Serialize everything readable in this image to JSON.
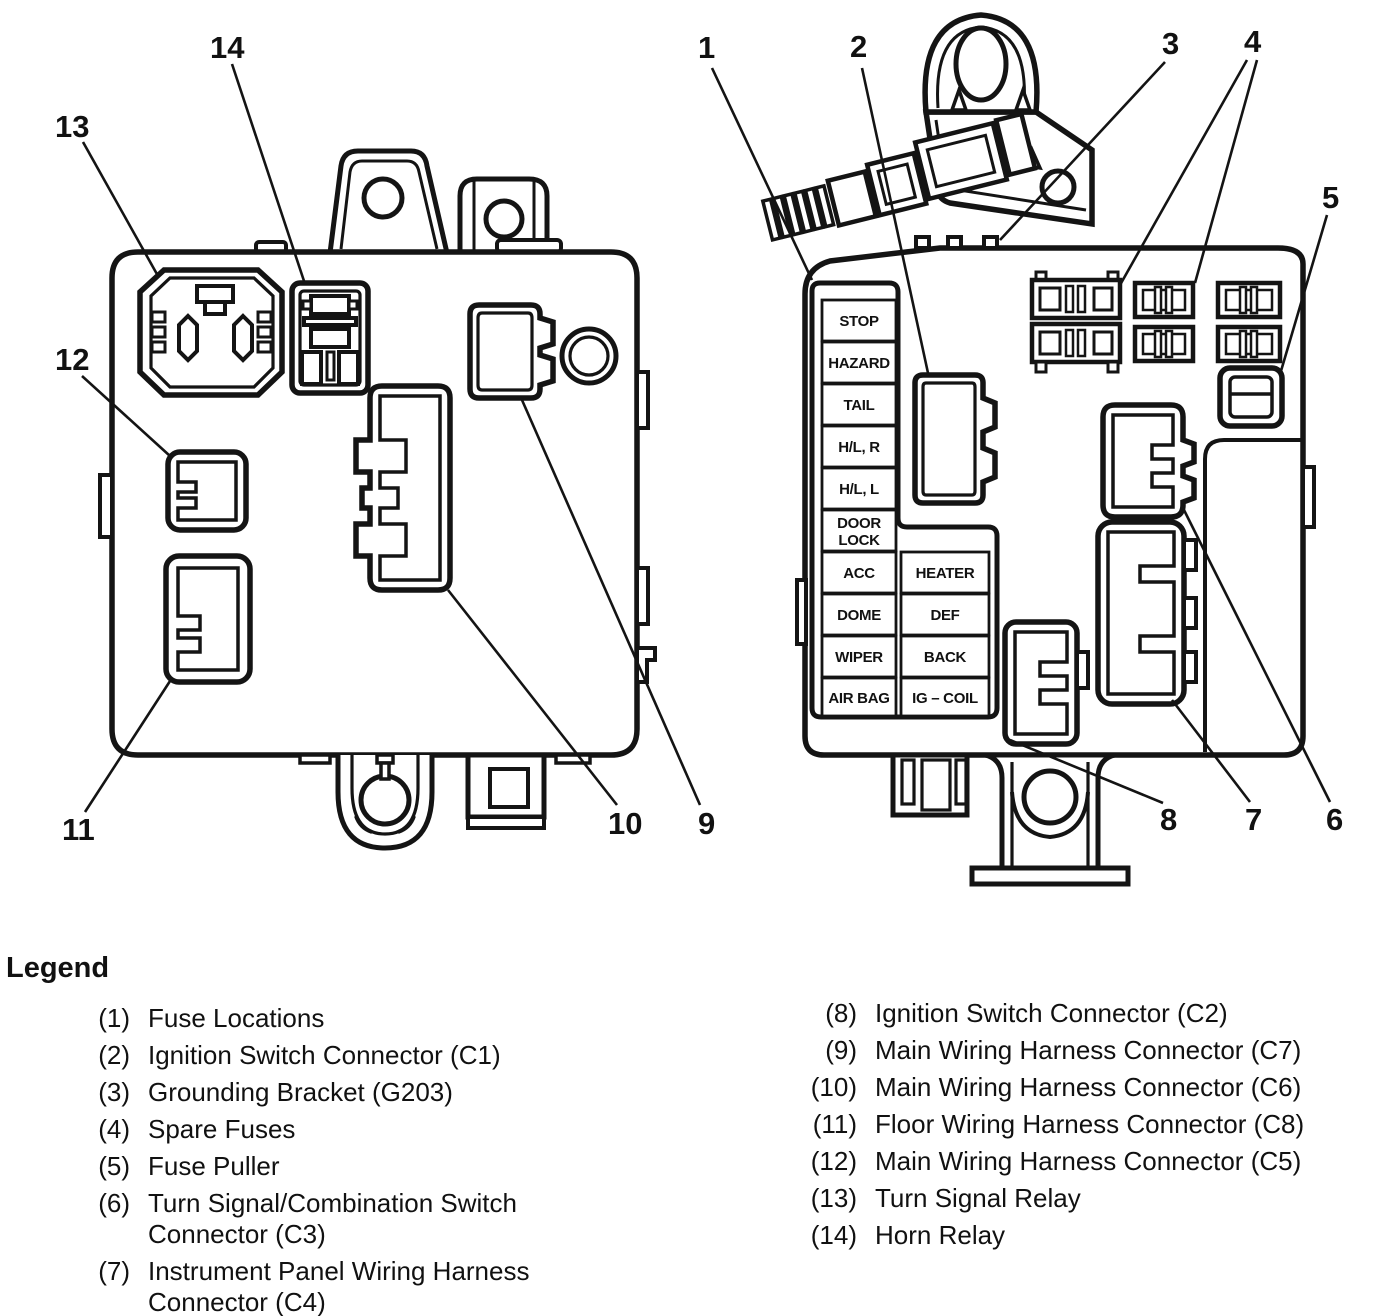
{
  "figure": {
    "type": "fuse-block-diagram",
    "views": [
      "fuse block rear view",
      "fuse block front view"
    ]
  },
  "callouts": {
    "n1": "1",
    "n2": "2",
    "n3": "3",
    "n4": "4",
    "n5": "5",
    "n6": "6",
    "n7": "7",
    "n8": "8",
    "n9": "9",
    "n10": "10",
    "n11": "11",
    "n12": "12",
    "n13": "13",
    "n14": "14"
  },
  "fuses": {
    "stop": "STOP",
    "hazard": "HAZARD",
    "tail": "TAIL",
    "hl_r": "H/L, R",
    "hl_l": "H/L, L",
    "door": "DOOR",
    "lock": "LOCK",
    "acc": "ACC",
    "dome": "DOME",
    "wiper": "WIPER",
    "air_bag": "AIR BAG",
    "heater": "HEATER",
    "def": "DEF",
    "back": "BACK",
    "ig_coil": "IG – COIL"
  },
  "legend": {
    "title": "Legend",
    "left": [
      {
        "num": "(1)",
        "label": "Fuse Locations"
      },
      {
        "num": "(2)",
        "label": "Ignition Switch Connector (C1)"
      },
      {
        "num": "(3)",
        "label": "Grounding Bracket (G203)"
      },
      {
        "num": "(4)",
        "label": "Spare Fuses"
      },
      {
        "num": "(5)",
        "label": "Fuse Puller"
      },
      {
        "num": "(6)",
        "label": "Turn Signal/Combination Switch",
        "label2": "Connector (C3)"
      },
      {
        "num": "(7)",
        "label": "Instrument Panel Wiring Harness",
        "label2": "Connector (C4)"
      }
    ],
    "right": [
      {
        "num": "(8)",
        "label": "Ignition Switch Connector (C2)"
      },
      {
        "num": "(9)",
        "label": "Main Wiring Harness Connector (C7)"
      },
      {
        "num": "(10)",
        "label": "Main Wiring Harness Connector (C6)"
      },
      {
        "num": "(11)",
        "label": "Floor Wiring Harness Connector (C8)"
      },
      {
        "num": "(12)",
        "label": "Main Wiring Harness Connector (C5)"
      },
      {
        "num": "(13)",
        "label": "Turn Signal Relay"
      },
      {
        "num": "(14)",
        "label": "Horn Relay"
      }
    ]
  },
  "colors": {
    "ink": "#141414",
    "paper": "#ffffff"
  }
}
